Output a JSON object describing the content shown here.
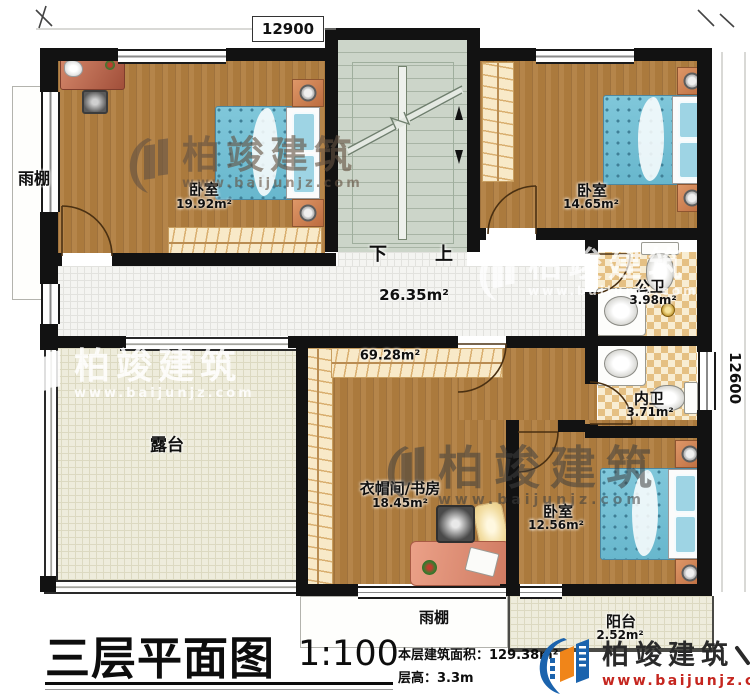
{
  "dimensions": {
    "top": "12900",
    "right": "12600"
  },
  "rooms": {
    "bedroom_tl": {
      "name": "卧室",
      "area": "19.92m²"
    },
    "bedroom_tr": {
      "name": "卧室",
      "area": "14.65m²"
    },
    "bedroom_br": {
      "name": "卧室",
      "area": "12.56m²"
    },
    "study": {
      "name": "衣帽间/书房",
      "area": "18.45m²"
    },
    "hallway": {
      "area": "26.35m²"
    },
    "middle_zone": {
      "area": "69.28m²"
    },
    "public_bath": {
      "name": "公卫",
      "area": "3.98m²"
    },
    "private_bath": {
      "name": "内卫",
      "area": "3.71m²"
    },
    "terrace": {
      "name": "露台"
    },
    "balcony": {
      "name": "阳台",
      "area": "2.52m²"
    },
    "canopy_left": {
      "name": "雨棚"
    },
    "canopy_bottom": {
      "name": "雨棚"
    }
  },
  "stairs": {
    "down": "下",
    "up": "上"
  },
  "titleblock": {
    "title": "三层平面图",
    "scale": "1:100",
    "area_label": "本层建筑面积：",
    "area_value": "129.38m²",
    "floor_height_label": "层高：",
    "floor_height_value": "3.3m"
  },
  "brand": {
    "name": "柏竣建筑",
    "url": "www.baijunjz.com"
  },
  "colors": {
    "wall": "#121212",
    "wood": "#b5854a",
    "stair": "#ccd5c9",
    "tile_light": "#f8edd3",
    "tile_dark": "#e5c083",
    "terrace": "#eeecdc",
    "bed_blue": "#80c7da",
    "logo_blue": "#1b63ad",
    "logo_orange": "#f08519",
    "url_red": "#c5261f"
  }
}
